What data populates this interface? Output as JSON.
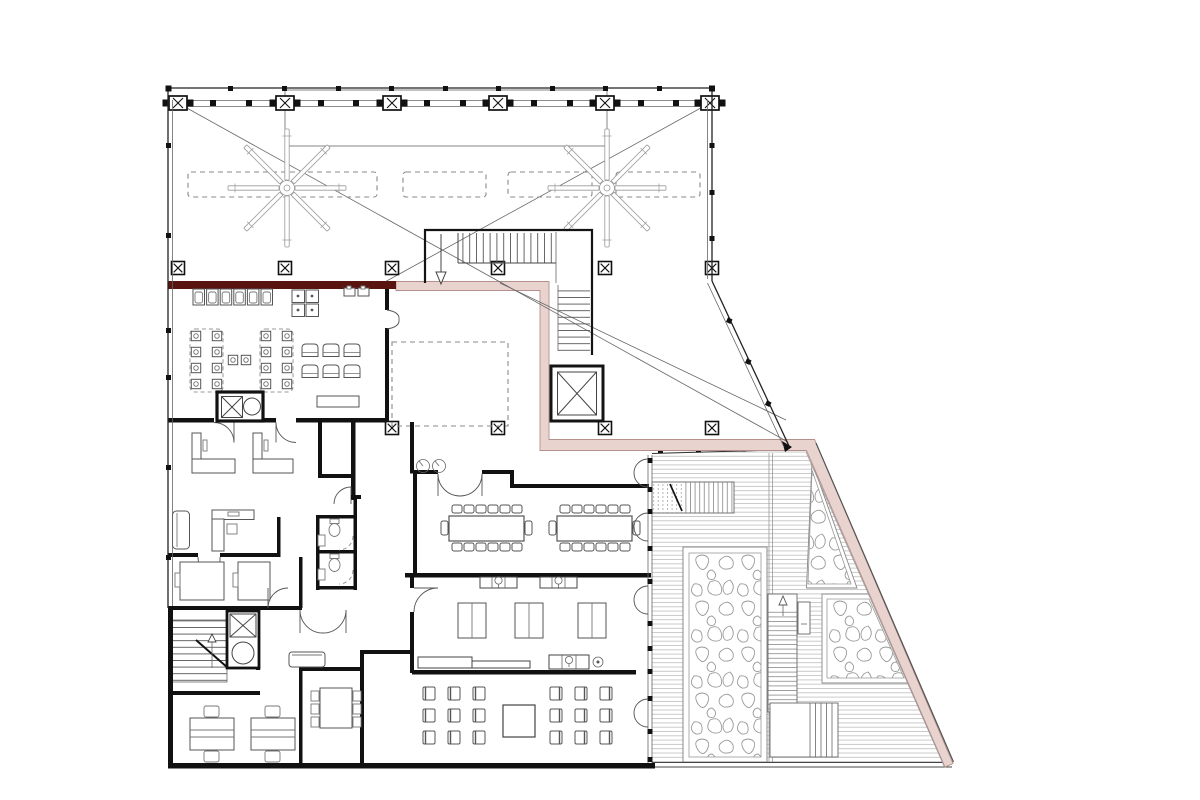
{
  "document": {
    "kind": "architectural-floor-plan",
    "description": "Upper floor plan: open roof hall with canopy beam, columns and two ceiling fans; central switchback stair and elevator; kitchen-dining wing behind a dark feature wall; offices, restrooms, lower stair and elevator core; conference room with two long tables; workshop and lecture seating rooms; outdoor timber deck with planters, stairs and a pink circulation band along the angled edge.",
    "visible_text": []
  },
  "colors": {
    "background": "#ffffff",
    "wall": "#141414",
    "feature_wall": "#5a1410",
    "walkway_band": "#e9d3cf",
    "walkway_edge": "#b5908a",
    "deck_line": "#b5b5b5",
    "foliage_line": "#9a9a9a"
  },
  "symbols": [
    {
      "name": "column-marker-icon",
      "meaning": "structural column (boxed X)",
      "count": 16
    },
    {
      "name": "ceiling-fan-icon",
      "meaning": "8-blade ceiling fan",
      "count": 2
    },
    {
      "name": "elevator-icon",
      "meaning": "elevator shaft (crossed box)",
      "count": 2
    },
    {
      "name": "stair-run-icon",
      "meaning": "stair flight with treads",
      "count": 5
    },
    {
      "name": "door-swing-icon",
      "meaning": "door leaf with swing arc",
      "count": 14
    },
    {
      "name": "toilet-icon",
      "meaning": "WC fixture",
      "count": 2
    },
    {
      "name": "planter-icon",
      "meaning": "planting bed (organic fill)",
      "count": 3
    }
  ],
  "areas": {
    "roof_hall": {
      "skylights": 4,
      "beam_columns": 6,
      "fans": 2
    },
    "dining": {
      "long_tables": 2,
      "seats_per_table": 8,
      "lounge_chairs": 6,
      "kitchen_units": 6,
      "burners": 4,
      "sinks": 2
    },
    "conference": {
      "tables": 2,
      "chairs_per_table": 14
    },
    "lecture_room": {
      "chairs": 18,
      "center_table": 1
    },
    "workshop": {
      "double_tables": 3
    },
    "offices": {
      "desks": 7,
      "sofas": 2,
      "meeting_table_seats": 6
    },
    "restrooms": {
      "stalls": 2
    },
    "deck": {
      "planters": 3,
      "stairs": 2,
      "steps": 1
    }
  }
}
